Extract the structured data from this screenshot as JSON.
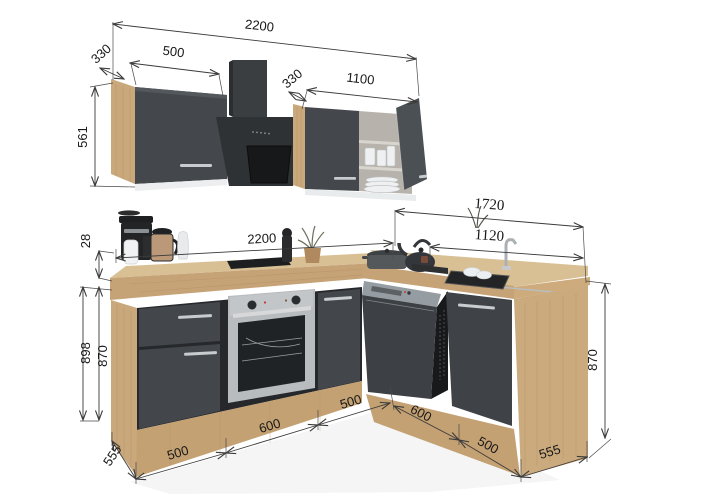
{
  "dims": {
    "wall_total": "2200",
    "wall_left_depth": "330",
    "wall_left_width": "500",
    "wall_height": "561",
    "wall_right_depth": "330",
    "wall_right_width": "1100",
    "worktop_thickness": "28",
    "base_front_width": "2200",
    "right_run_total": "1720",
    "right_run_counter": "1120",
    "total_height": "898",
    "left_cabinet_height": "870",
    "right_cabinet_height": "870",
    "left_end_depth": "555",
    "unit1_width": "500",
    "unit2_width": "600",
    "unit3_width": "500",
    "unit4_width": "600",
    "unit5_width": "500",
    "right_end_depth": "555"
  },
  "colors": {
    "cabinet_front": "#43474b",
    "cabinet_shadow": "#26282b",
    "wood": "#c8a77a",
    "wood_light": "#d9c094",
    "steel": "#c3c6c8",
    "dimension_line": "#3a3a3a",
    "background": "#ffffff"
  }
}
